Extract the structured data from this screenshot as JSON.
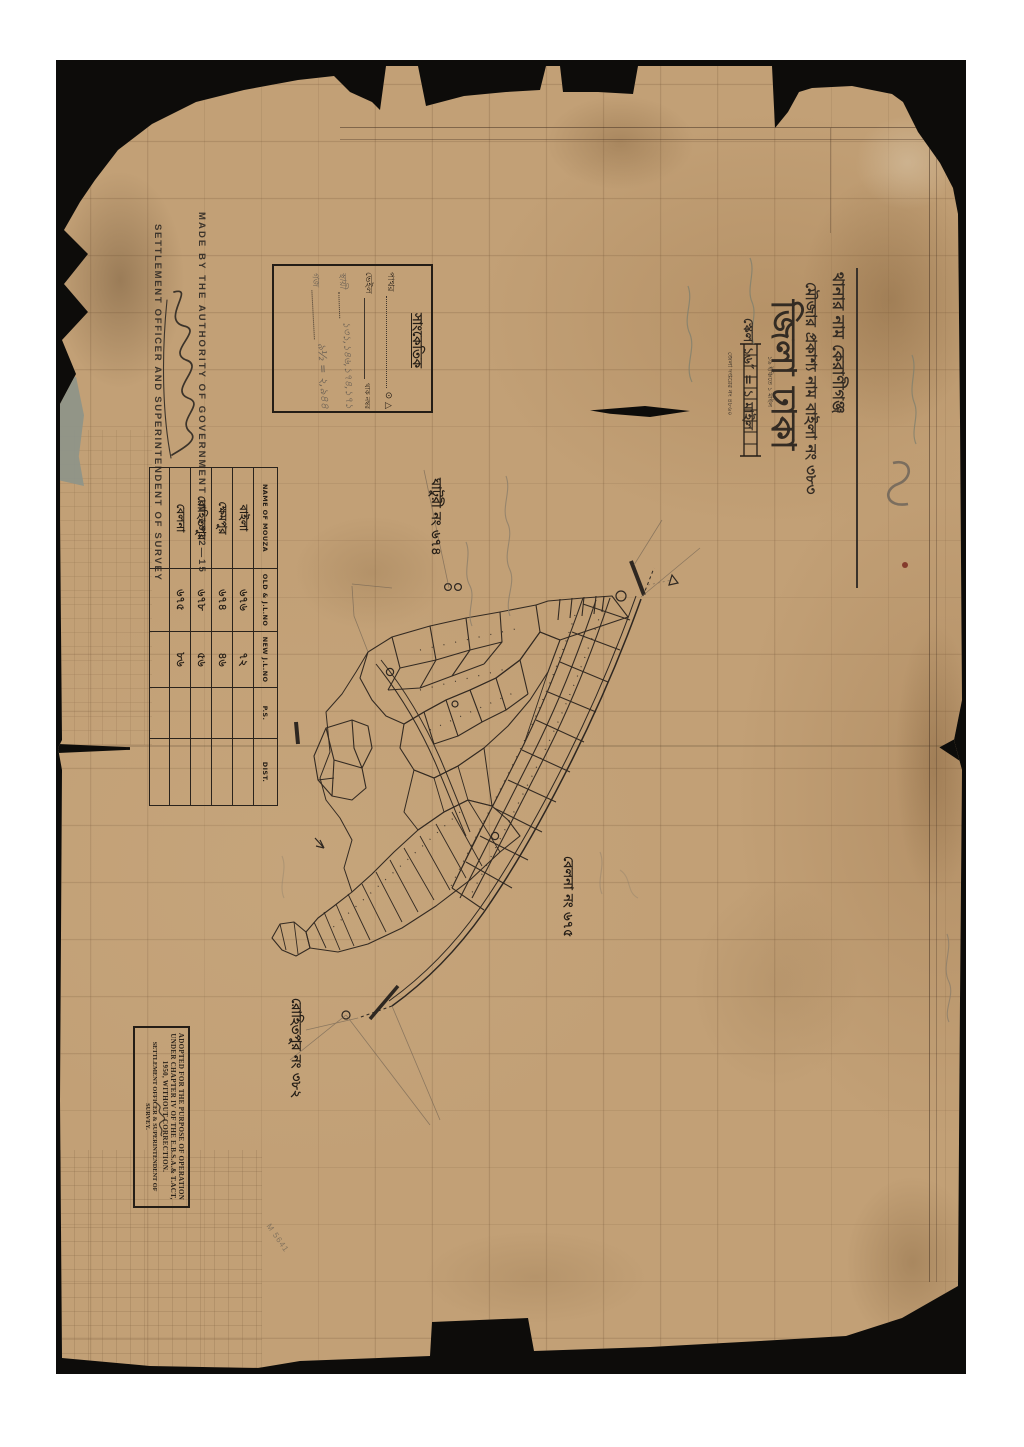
{
  "title_block": {
    "thana_line": "থানার নাম কেরাণীগঞ্জ",
    "mouza_line": "মৌজার প্রকাশ্য নাম বাইলা নং ৩৮৩",
    "district_line": "জিলা ঢাকা",
    "scale_line": "স্কেল ১৬″ = ১ মাইল",
    "scale_bar_note": "১৬ ইঞ্চিতে ১ মাইল",
    "registry_note": "জেলা দপ্তরের নং ৪৮৬০"
  },
  "authority": {
    "made_by": "MADE BY THE AUTHORITY OF GOVERNMENT IN 1912—15",
    "officer": "SETTLEMENT OFFICER AND SUPERINTENDENT OF SURVEY"
  },
  "legend": {
    "title": "সাংকেতিক",
    "rows": [
      {
        "label": "পাথর",
        "symbols": "⊙ △"
      },
      {
        "label": "ভেইল",
        "sublabel": "থাক নম্বর"
      },
      {
        "label": "স্থায়ী",
        "value": "১৩১,১৪৬,১৭৪,১৭১"
      },
      {
        "label": "গজ",
        "value": "৯½ = ২,৯৪৪"
      }
    ]
  },
  "mouza_table": {
    "headers": [
      "NAME OF MOUZA",
      "OLD & J.L.NO",
      "NEW J.L.NO",
      "P.S.",
      "DIST."
    ],
    "rows": [
      {
        "name": "বাইলা",
        "old_jl": "৬৭৬",
        "new_jl": "৭২",
        "ps": "",
        "dist": ""
      },
      {
        "name": "ক্ষেমপুর",
        "old_jl": "৬৭৪",
        "new_jl": "৪৬",
        "ps": "",
        "dist": ""
      },
      {
        "name": "রোহিতপুর",
        "old_jl": "৬৭৮",
        "new_jl": "৫৬",
        "ps": "",
        "dist": ""
      },
      {
        "name": "বেলনা",
        "old_jl": "৬৭৫",
        "new_jl": "৮৬",
        "ps": "",
        "dist": ""
      }
    ]
  },
  "map_labels": [
    {
      "text": "ঘাটুরী নং ৬৭৪"
    },
    {
      "text": "বেলনা নং ৬৭৫"
    },
    {
      "text": "রোহিতপুর নং ৩৮২"
    }
  ],
  "stamp": {
    "line1": "ADOPTED FOR THE PURPOSE OF OPERATION",
    "line2": "UNDER CHAPTER IV OF THE E.B.S.A.& T.ACT,",
    "line3": "1950, WITHOUT CORRECTION.",
    "officer": "SETTLEMENT OFFICER & SUPERINTENDENT OF SURVEY."
  },
  "annotations": {
    "stamp_code": "M 5641"
  },
  "colors": {
    "paper": "#c2a076",
    "ink": "#2e2721",
    "pencil": "#8d7f6b",
    "backdrop": "#0d0c0a"
  }
}
